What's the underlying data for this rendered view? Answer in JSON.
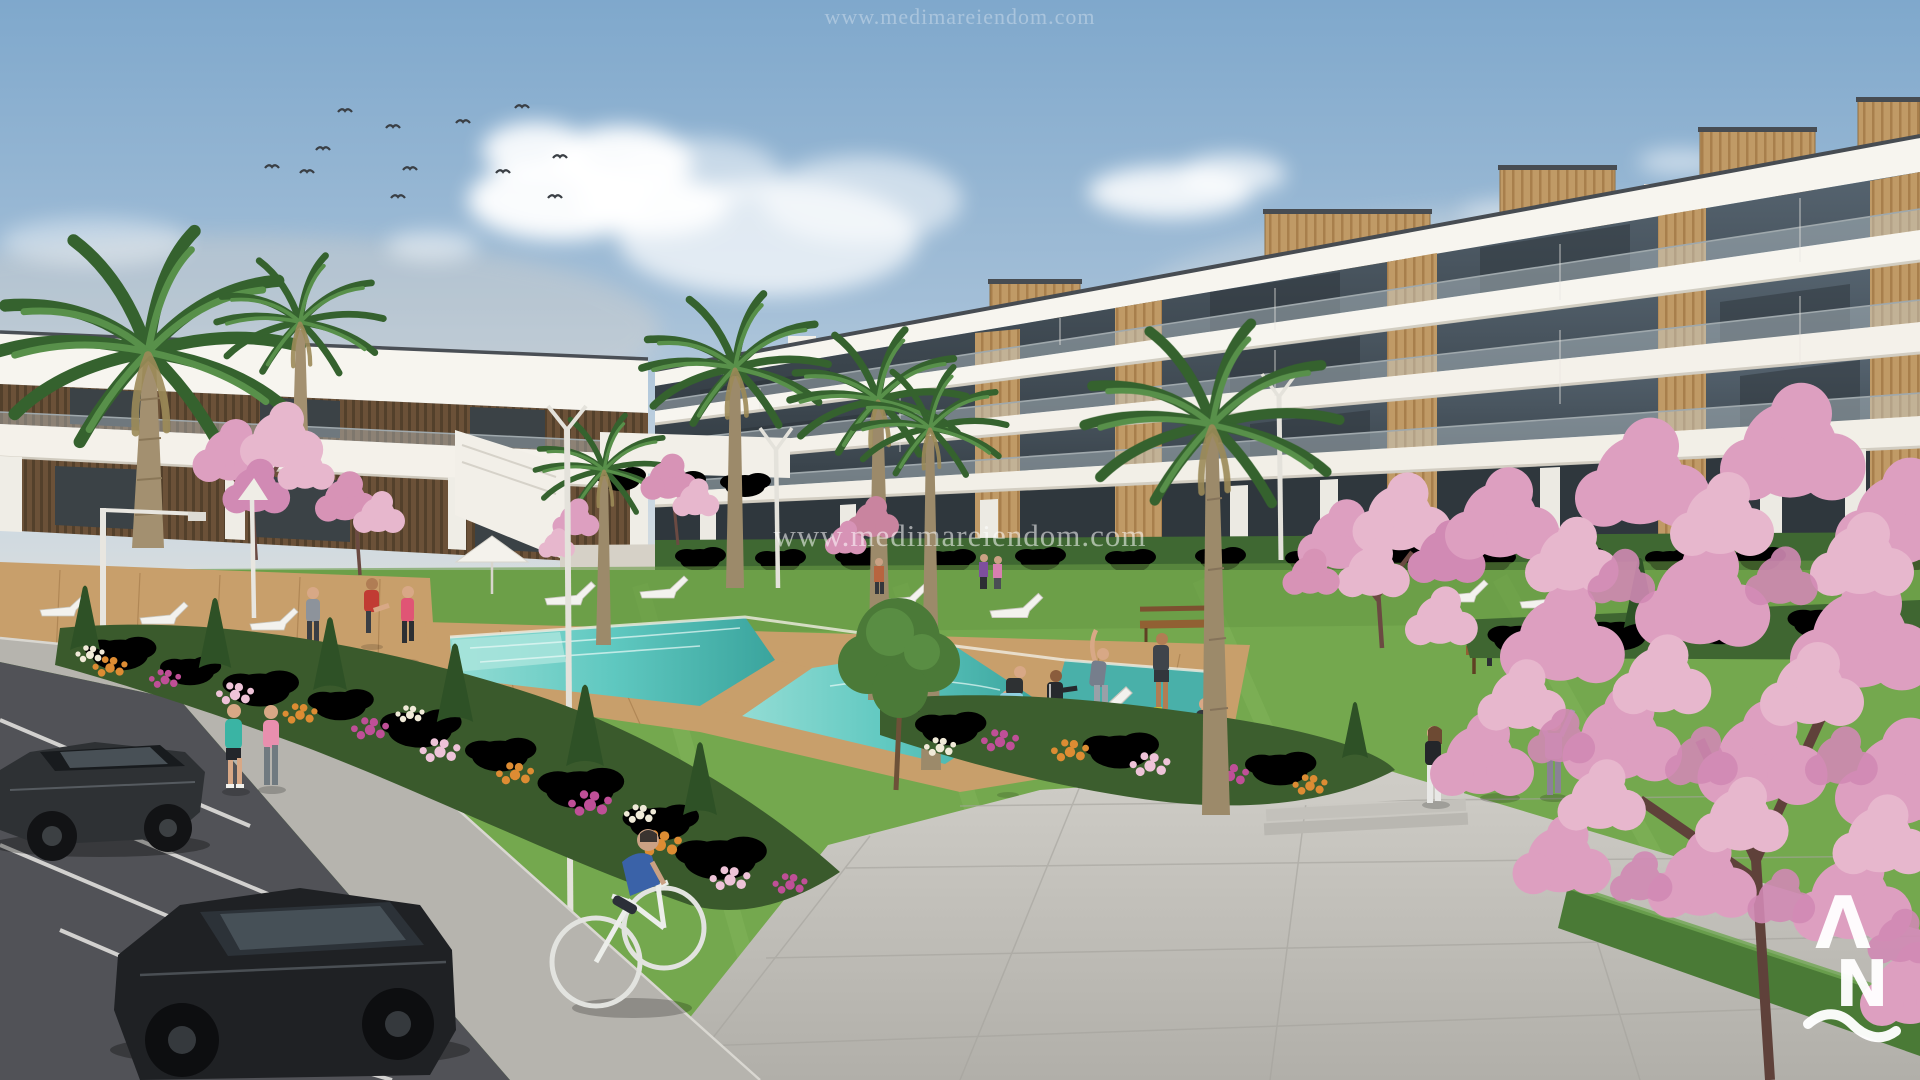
{
  "image": {
    "kind": "architectural-render",
    "watermark": {
      "text": "www.medimareiendom.com"
    },
    "logo": {
      "glyph_a": "Λ",
      "glyph_n": "N",
      "wave": "~"
    }
  },
  "palette": {
    "sky_top": "#7fa8cc",
    "sky_horizon": "#e3e0d8",
    "building_white": "#f7f5ef",
    "wood_panel": "#c09a66",
    "window_glass": "#39424a",
    "pool_water": "#5fc8c0",
    "deck_wood": "#c89f6b",
    "lawn_green": "#74a84e",
    "hedge_green": "#3f6631",
    "flower_orange": "#dd8c33",
    "flower_magenta": "#bf4f97",
    "blossom_pink": "#e0a8c4",
    "asphalt": "#515257",
    "pavement": "#c2c0ba",
    "logo_white": "#ffffff"
  }
}
